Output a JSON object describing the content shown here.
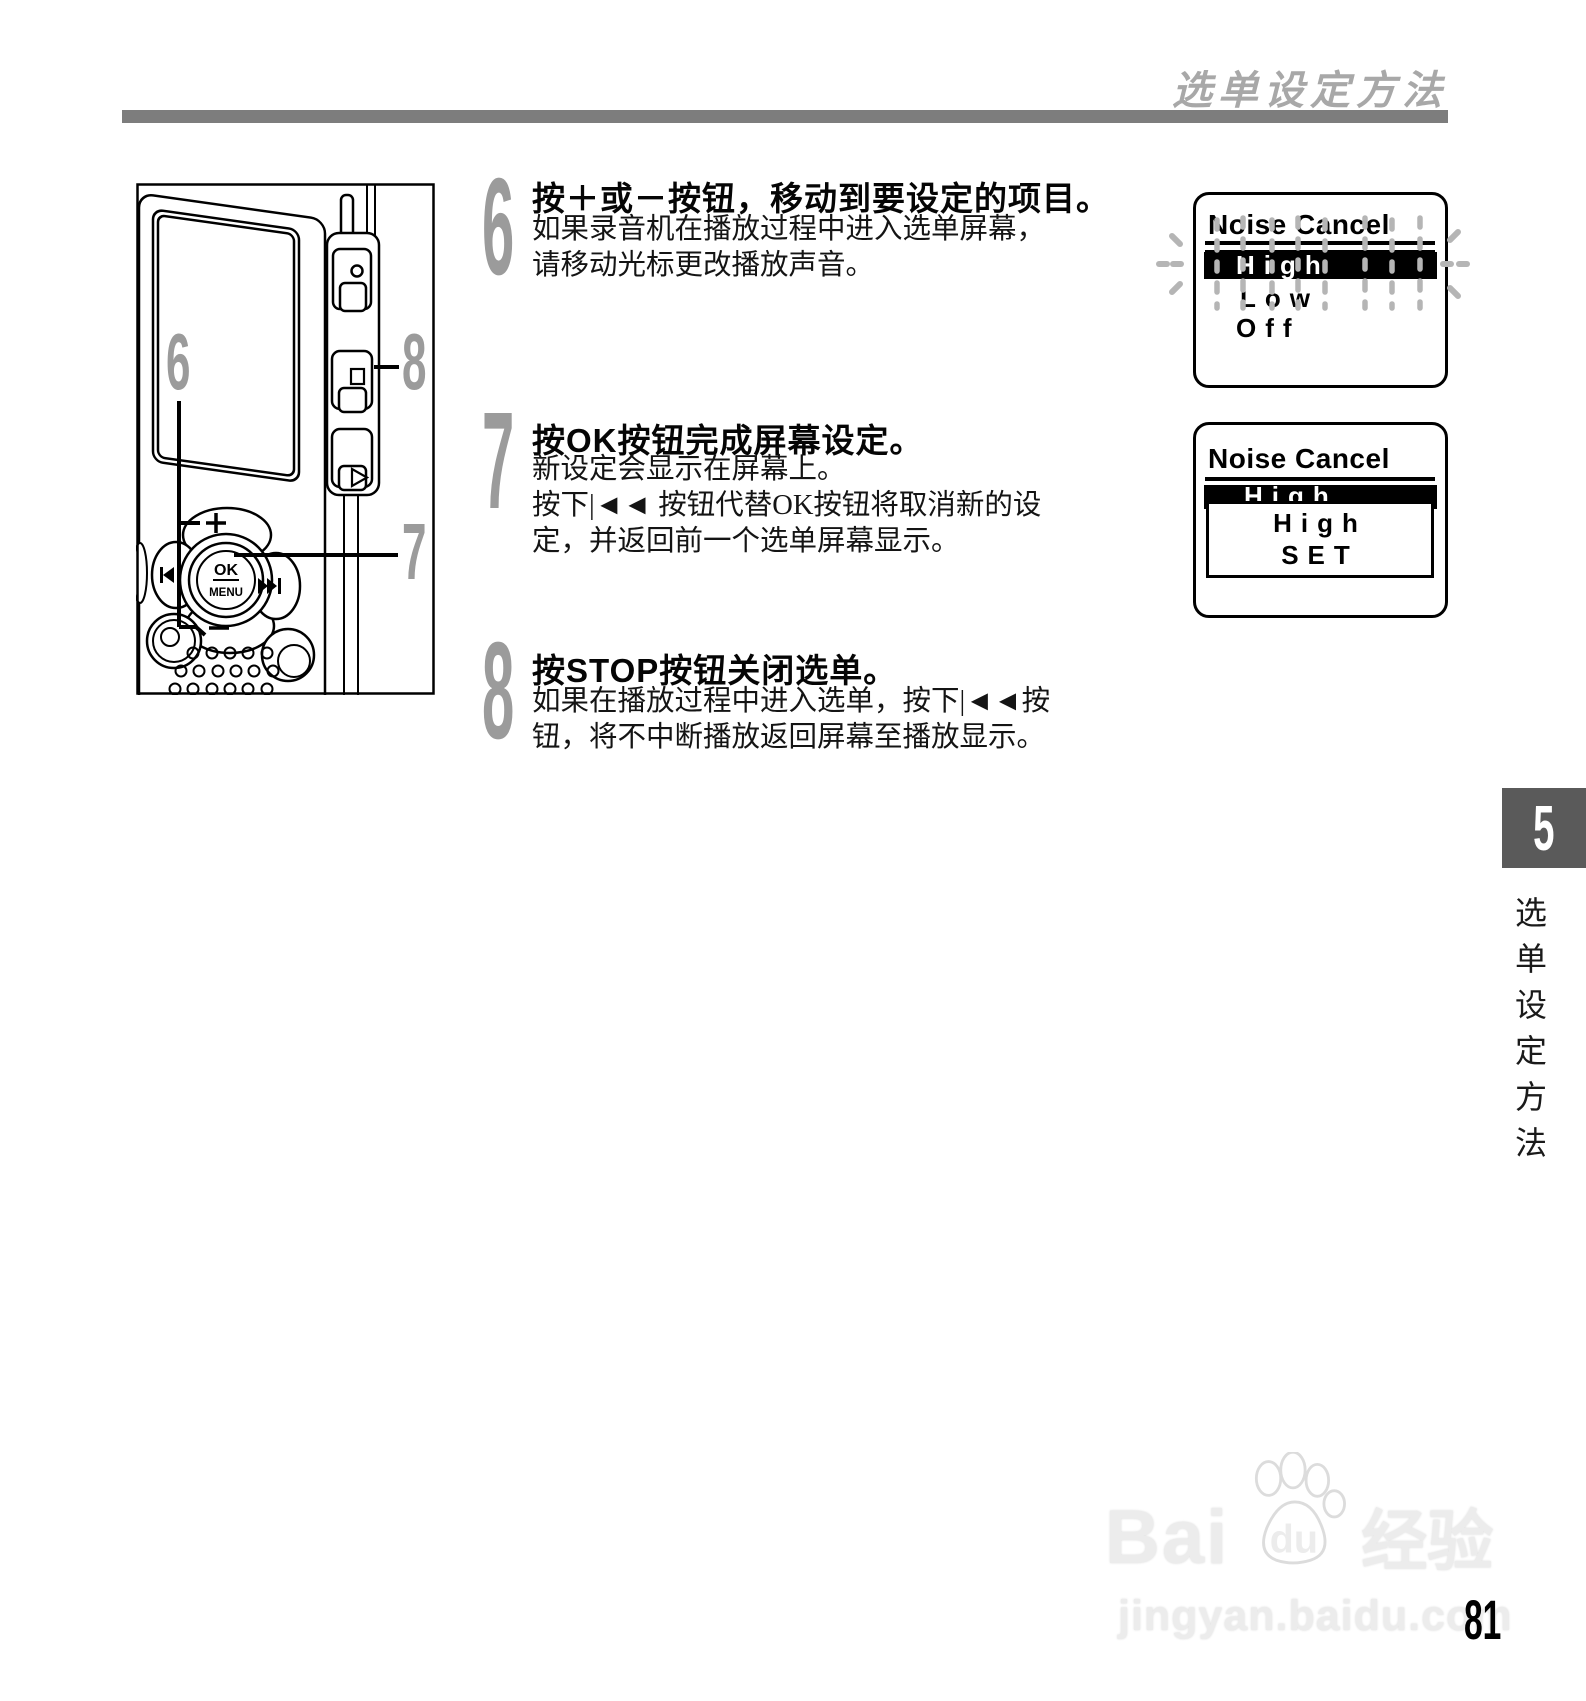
{
  "header": {
    "title": "选单设定方法"
  },
  "steps": [
    {
      "number": "6",
      "title": "按＋或－按钮，移动到要设定的项目。",
      "lines": [
        "如果录音机在播放过程中进入选单屏幕，",
        "请移动光标更改播放声音。"
      ]
    },
    {
      "number": "7",
      "title": "按OK按钮完成屏幕设定。",
      "lines": [
        "新设定会显示在屏幕上。",
        "按下|◄◄ 按钮代替OK按钮将取消新的设",
        "定，并返回前一个选单屏幕显示。"
      ]
    },
    {
      "number": "8",
      "title": "按STOP按钮关闭选单。",
      "lines": [
        "如果在播放过程中进入选单，按下|◄◄按",
        "钮，将不中断播放返回屏幕至播放显示。"
      ]
    }
  ],
  "device": {
    "callouts": {
      "plus_minus": "6",
      "ok": "7",
      "stop": "8"
    },
    "buttons": {
      "ok": "OK",
      "menu": "MENU"
    },
    "icons": [
      "plus",
      "minus",
      "prev-track",
      "next-track",
      "record",
      "stop",
      "play",
      "speaker-grill"
    ]
  },
  "screens": {
    "menu_list": {
      "title": "Noise Cancel",
      "items": [
        "High",
        "Low",
        "Off"
      ],
      "selected": "High"
    },
    "confirm": {
      "title": "Noise Cancel",
      "selected": "High",
      "popup": [
        "High",
        "SET"
      ]
    }
  },
  "sidebar": {
    "chapter_number": "5",
    "chapter_label": "选单设定方法"
  },
  "footer": {
    "page_number": "81"
  },
  "watermark": {
    "brand": "Bai",
    "brand2": "du",
    "suffix": "经验",
    "url": "jingyan.baidu.com"
  }
}
